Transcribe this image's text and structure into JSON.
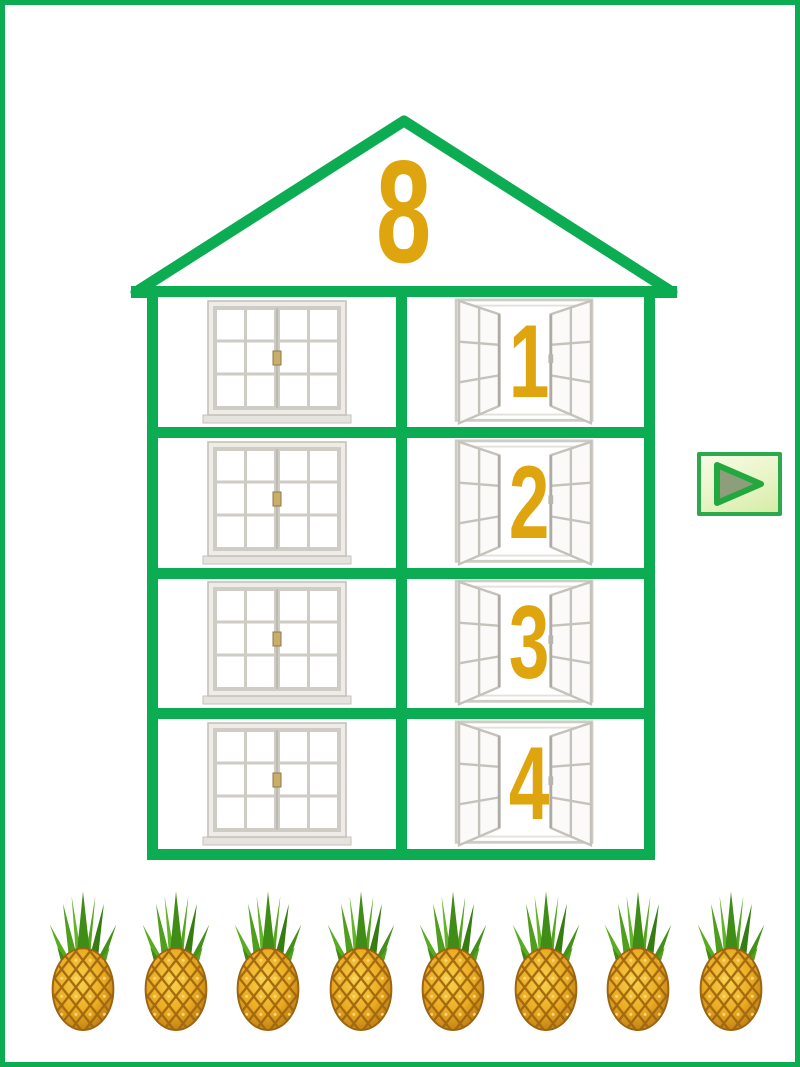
{
  "page": {
    "background_color": "#FFFFFF",
    "border_color": "#0BAC52"
  },
  "colors": {
    "house_green": "#0BAC52",
    "number_gold": "#DFA50E",
    "btn_border": "#2CA94C",
    "btn_tri_fill": "#8E9E7B"
  },
  "house": {
    "roof_number": "8",
    "floors": [
      {
        "left_window": "closed-window",
        "right_window": "open-window",
        "number": "1"
      },
      {
        "left_window": "closed-window",
        "right_window": "open-window",
        "number": "2"
      },
      {
        "left_window": "closed-window",
        "right_window": "open-window",
        "number": "3"
      },
      {
        "left_window": "closed-window",
        "right_window": "open-window",
        "number": "4"
      }
    ]
  },
  "next_button": {
    "icon": "play-triangle-icon"
  },
  "counters": {
    "item_icon": "pineapple-icon",
    "count": 8
  }
}
